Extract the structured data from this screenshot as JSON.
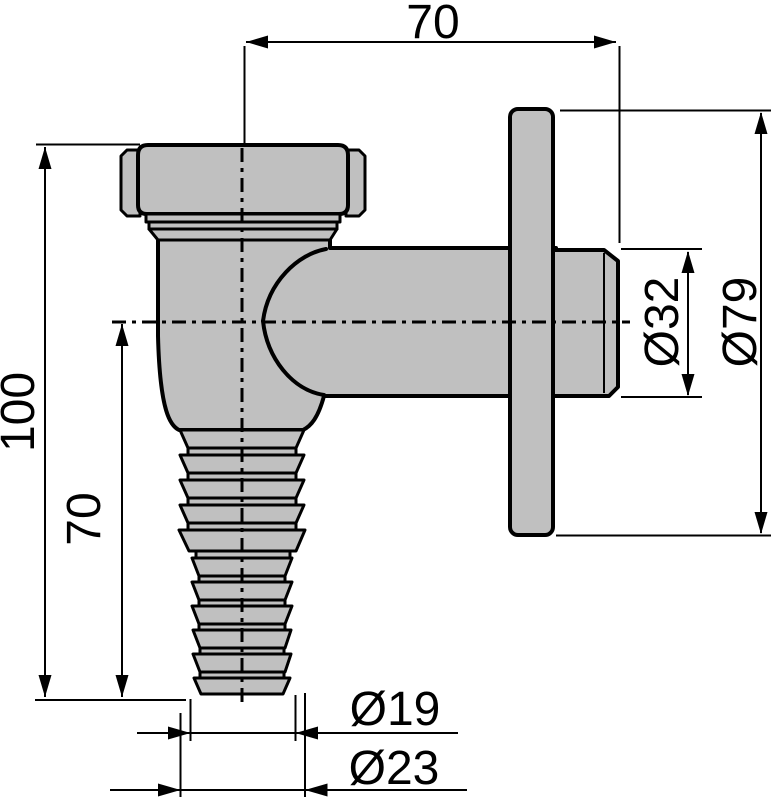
{
  "page": {
    "background": "#ffffff"
  },
  "drawing": {
    "stroke_color": "#000000",
    "fill_color": "#c0c0c0",
    "labels": {
      "top_width": "70",
      "overall_height": "100",
      "hose_length": "70",
      "outlet_diameter": "Ø32",
      "flange_diameter": "Ø79",
      "hose_end_diameter": "Ø19",
      "hose_barb_diameter": "Ø23"
    }
  }
}
